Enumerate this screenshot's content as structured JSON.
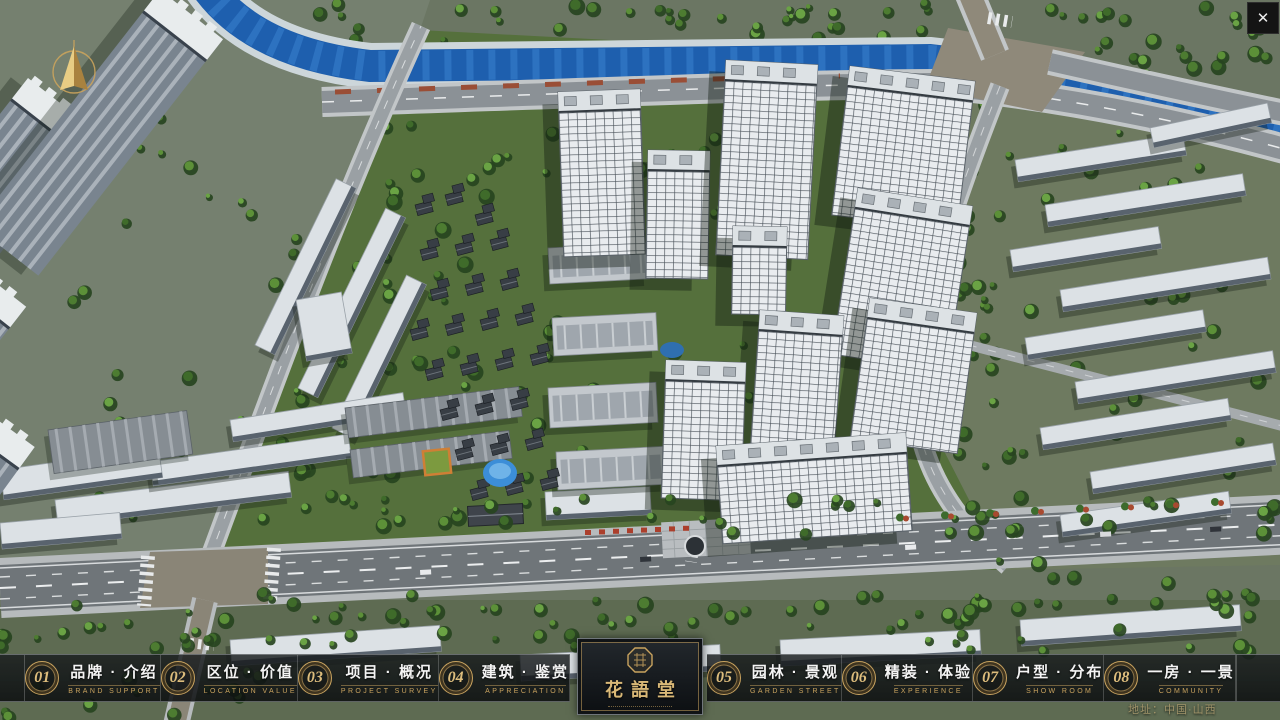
{
  "ui": {
    "close_glyph": "✕",
    "address": "地址：中国·山西"
  },
  "nav": {
    "items": [
      {
        "num": "01",
        "title": "品牌 · 介绍",
        "subtitle": "BRAND SUPPORT"
      },
      {
        "num": "02",
        "title": "区位 · 价值",
        "subtitle": "LOCATION VALUE"
      },
      {
        "num": "03",
        "title": "项目 · 概况",
        "subtitle": "PROJECT SURVEY"
      },
      {
        "num": "04",
        "title": "建筑 · 鉴赏",
        "subtitle": "APPRECIATION"
      },
      {
        "num": "05",
        "title": "园林 · 景观",
        "subtitle": "GARDEN STREET"
      },
      {
        "num": "06",
        "title": "精装 · 体验",
        "subtitle": "EXPERIENCE"
      },
      {
        "num": "07",
        "title": "户型 · 分布",
        "subtitle": "SHOW ROOM"
      },
      {
        "num": "08",
        "title": "一房 · 一景",
        "subtitle": "COMMUNITY"
      }
    ]
  },
  "logo": {
    "title": "花語堂"
  },
  "colors": {
    "gold": "#c9a35f",
    "river": "#1e5fae",
    "bar_bg": "rgba(16,19,21,0.82)"
  }
}
